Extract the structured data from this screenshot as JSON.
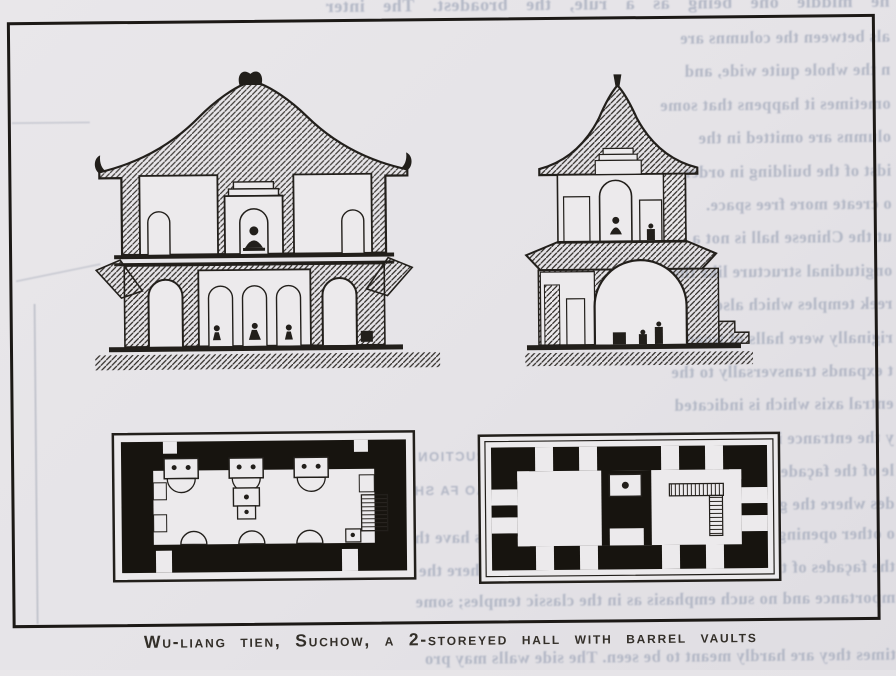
{
  "figure": {
    "caption": "Wu-liang tien, Suchow, a 2-storeyed hall with barrel vaults",
    "drawings": [
      {
        "name": "left-cross-section",
        "description": "cross section of 2-storeyed hall with hip roofs, arched niches and Buddha figures"
      },
      {
        "name": "right-cross-section",
        "description": "transverse cross section with pyramidal roof, barrel vault and stepped base"
      },
      {
        "name": "left-floor-plan",
        "description": "floor plan with three shrines, three apses and stair"
      },
      {
        "name": "right-floor-plan",
        "description": "floor plan with two square rooms, central altar and stair"
      }
    ]
  },
  "showthrough": {
    "top_line": "he middle one being as a rule, the broadest. The inter",
    "column_lines": [
      "als between the columns are",
      "n the whole quite wide, and",
      "ometimes it happens that some",
      "olumns are omitted in the",
      "idst of the building in order",
      "o create more free space.",
      "ut the Chinese hall is not a",
      "ongitudinal structure like the",
      "reek temples which also",
      "riginally were halls of wood;",
      "t expands transversally to the",
      "entral axis which is indicated",
      "y the entrance in the broad mid-",
      "le of the façade. The two short",
      "des where the gables were"
    ],
    "full_lines": [
      "o other openings than the doorways, and the gable walls have thus remained of little decorative",
      "the façades of the halls and the gable walls were given there the decorative",
      "mportance and no such emphasis as in the classic temples; some"
    ],
    "fig_caption_lines": [
      "FIG. CONSTRUCTION ACCORDING",
      "YING TSAO FA SHIH (1103)"
    ],
    "below_caption_line": "times they are hardly meant to be seen. The side walls may pro"
  },
  "colors": {
    "paper": "#e6e4e7",
    "drawing_paper": "#eceaec",
    "ink": "#201d19",
    "showthrough_text": "#aab0c0"
  }
}
